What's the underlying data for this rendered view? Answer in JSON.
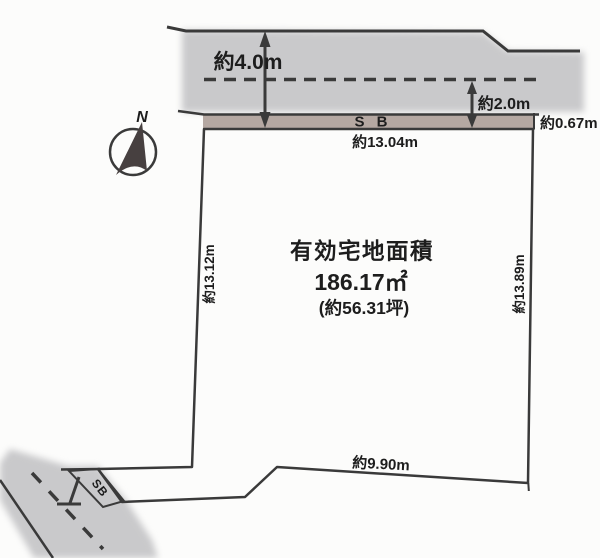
{
  "diagram": {
    "compass": {
      "north_label": "N"
    },
    "road_top": {
      "width_label": "約4.0m",
      "center_to_edge_label": "約2.0m",
      "setback_label": "S B",
      "setback_depth_label": "約0.67m"
    },
    "plot": {
      "title": "有効宅地面積",
      "area_sqm": "186.17㎡",
      "area_tsubo": "(約56.31坪)",
      "edge_top_label": "約13.04m",
      "edge_left_label": "約13.12m",
      "edge_right_label": "約13.89m",
      "edge_bottom_label": "約9.90m"
    },
    "road_bottom": {
      "setback_label": "SB"
    }
  },
  "colors": {
    "plot_green": "#cdeec5",
    "road_gray": "#c9c9cb",
    "setback_brown": "#b5a8a2",
    "line_dark": "#3a3a3a",
    "text_dark": "#1d1d1d",
    "background": "#fcfcfb"
  }
}
